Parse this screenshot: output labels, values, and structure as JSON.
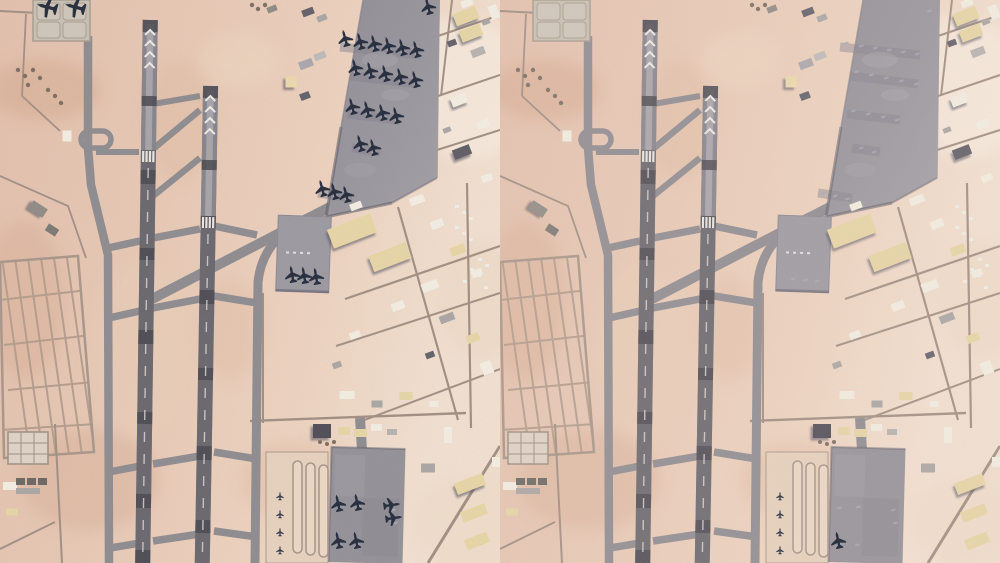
{
  "meta": {
    "content_type": "satellite-imagery-comparison",
    "scene": "desert military airbase, two parallel runways with taxiway loops, large diagonal parking apron (north-east), mid apron, south apron, building district east of runways",
    "panel_count": 2
  },
  "colors": {
    "desert": "#e7c9b6",
    "desert_light": "#f1e0d1",
    "desert_dark": "#d3a98f",
    "runway": "#75737b",
    "runway_dark": "#4a4951",
    "runway_center": "#a6a4aa",
    "taxiway": "#8e8c91",
    "apron_gray": "#98969e",
    "apron_shadow": "#5a5865",
    "apron_light": "#e6d1be",
    "building_white": "#f2ede2",
    "building_tan": "#e6d5a6",
    "building_gray": "#a9a6a4",
    "building_dark": "#63616b",
    "aircraft": "#2b3140",
    "marking_white": "#eceae6",
    "road": "#a18f83"
  },
  "aircraft_format": [
    "x",
    "y",
    "rotation_deg",
    "scale",
    "type"
  ],
  "panels": {
    "left": {
      "name": "satellite-view-left-aircraft-present",
      "aircraft_visible": 32,
      "stand_markings": 4,
      "aircraft": [
        [
          47,
          7,
          -75,
          1.15,
          "transport"
        ],
        [
          75,
          7,
          -75,
          1.15,
          "transport"
        ],
        [
          428,
          6
        ],
        [
          345,
          38
        ],
        [
          360,
          41
        ],
        [
          374,
          43
        ],
        [
          388,
          45
        ],
        [
          402,
          47
        ],
        [
          416,
          49
        ],
        [
          355,
          67
        ],
        [
          370,
          70
        ],
        [
          385,
          73
        ],
        [
          400,
          76
        ],
        [
          415,
          79
        ],
        [
          352,
          106
        ],
        [
          367,
          109
        ],
        [
          382,
          112
        ],
        [
          396,
          115
        ],
        [
          360,
          143
        ],
        [
          373,
          147
        ],
        [
          322,
          188
        ],
        [
          334,
          191
        ],
        [
          346,
          194
        ],
        [
          292,
          274,
          -10
        ],
        [
          304,
          275,
          -10
        ],
        [
          316,
          276,
          -10
        ],
        [
          338,
          503,
          -12
        ],
        [
          357,
          502,
          -12
        ],
        [
          392,
          505,
          82
        ],
        [
          394,
          518,
          82
        ],
        [
          338,
          540,
          -12
        ],
        [
          356,
          540,
          -12
        ],
        [
          280,
          496,
          0,
          0.5,
          "small"
        ],
        [
          280,
          514,
          0,
          0.5,
          "small"
        ],
        [
          280,
          532,
          0,
          0.5,
          "small"
        ],
        [
          280,
          550,
          0,
          0.5,
          "small"
        ]
      ]
    },
    "right": {
      "name": "satellite-view-right-aircraft-absent",
      "aircraft_visible": 1,
      "stand_markings": 4,
      "aircraft": [
        [
          338,
          540,
          -12
        ],
        [
          280,
          496,
          0,
          0.5,
          "small"
        ],
        [
          280,
          514,
          0,
          0.5,
          "small"
        ],
        [
          280,
          532,
          0,
          0.5,
          "small"
        ],
        [
          280,
          550,
          0,
          0.5,
          "small"
        ]
      ]
    }
  }
}
